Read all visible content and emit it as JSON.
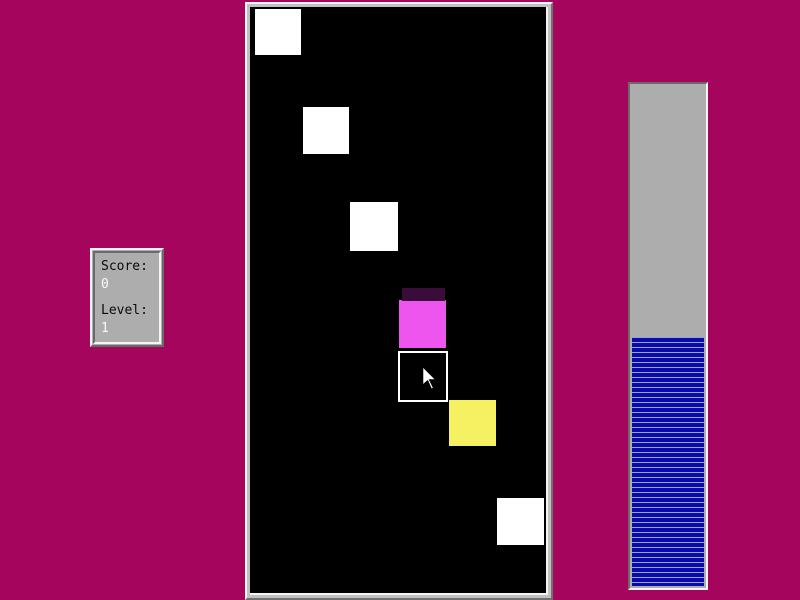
{
  "colors": {
    "background": "#A5055C",
    "frame_light": "#F5F5F5",
    "frame_mid": "#C0C0C0",
    "frame_dark": "#6A6A6A",
    "panel_gray": "#ADADAD",
    "gauge_blue": "#0A0AA8",
    "gauge_separator": "#9AA0DC"
  },
  "scoreboard": {
    "score_label": "Score:",
    "score_value": "0",
    "level_label": "Level:",
    "level_value": "1"
  },
  "playfield": {
    "background": "#000000",
    "squares": [
      {
        "name": "white-square-1",
        "x": 5,
        "y": 2,
        "w": 46,
        "h": 46,
        "color": "#FFFFFF"
      },
      {
        "name": "white-square-2",
        "x": 53,
        "y": 100,
        "w": 46,
        "h": 47,
        "color": "#FFFFFF"
      },
      {
        "name": "white-square-3",
        "x": 100,
        "y": 195,
        "w": 48,
        "h": 49,
        "color": "#FFFFFF"
      },
      {
        "name": "magenta-square-fading-edge",
        "x": 152,
        "y": 281,
        "w": 43,
        "h": 13,
        "color": "#390C39"
      },
      {
        "name": "magenta-square",
        "x": 149,
        "y": 293,
        "w": 47,
        "h": 48,
        "color": "#EE55EE"
      },
      {
        "name": "yellow-square",
        "x": 199,
        "y": 393,
        "w": 47,
        "h": 46,
        "color": "#F5F162"
      },
      {
        "name": "white-square-4",
        "x": 247,
        "y": 491,
        "w": 47,
        "h": 47,
        "color": "#FFFFFF"
      }
    ],
    "selector": {
      "x": 148,
      "y": 344,
      "w": 50,
      "h": 51
    },
    "cursor": {
      "x": 171,
      "y": 357,
      "w": 17,
      "h": 28
    }
  },
  "progress": {
    "fill_height_px": 249,
    "fill_percent": 49,
    "stripe_period_px": 5,
    "stripe_line_px": 1
  }
}
